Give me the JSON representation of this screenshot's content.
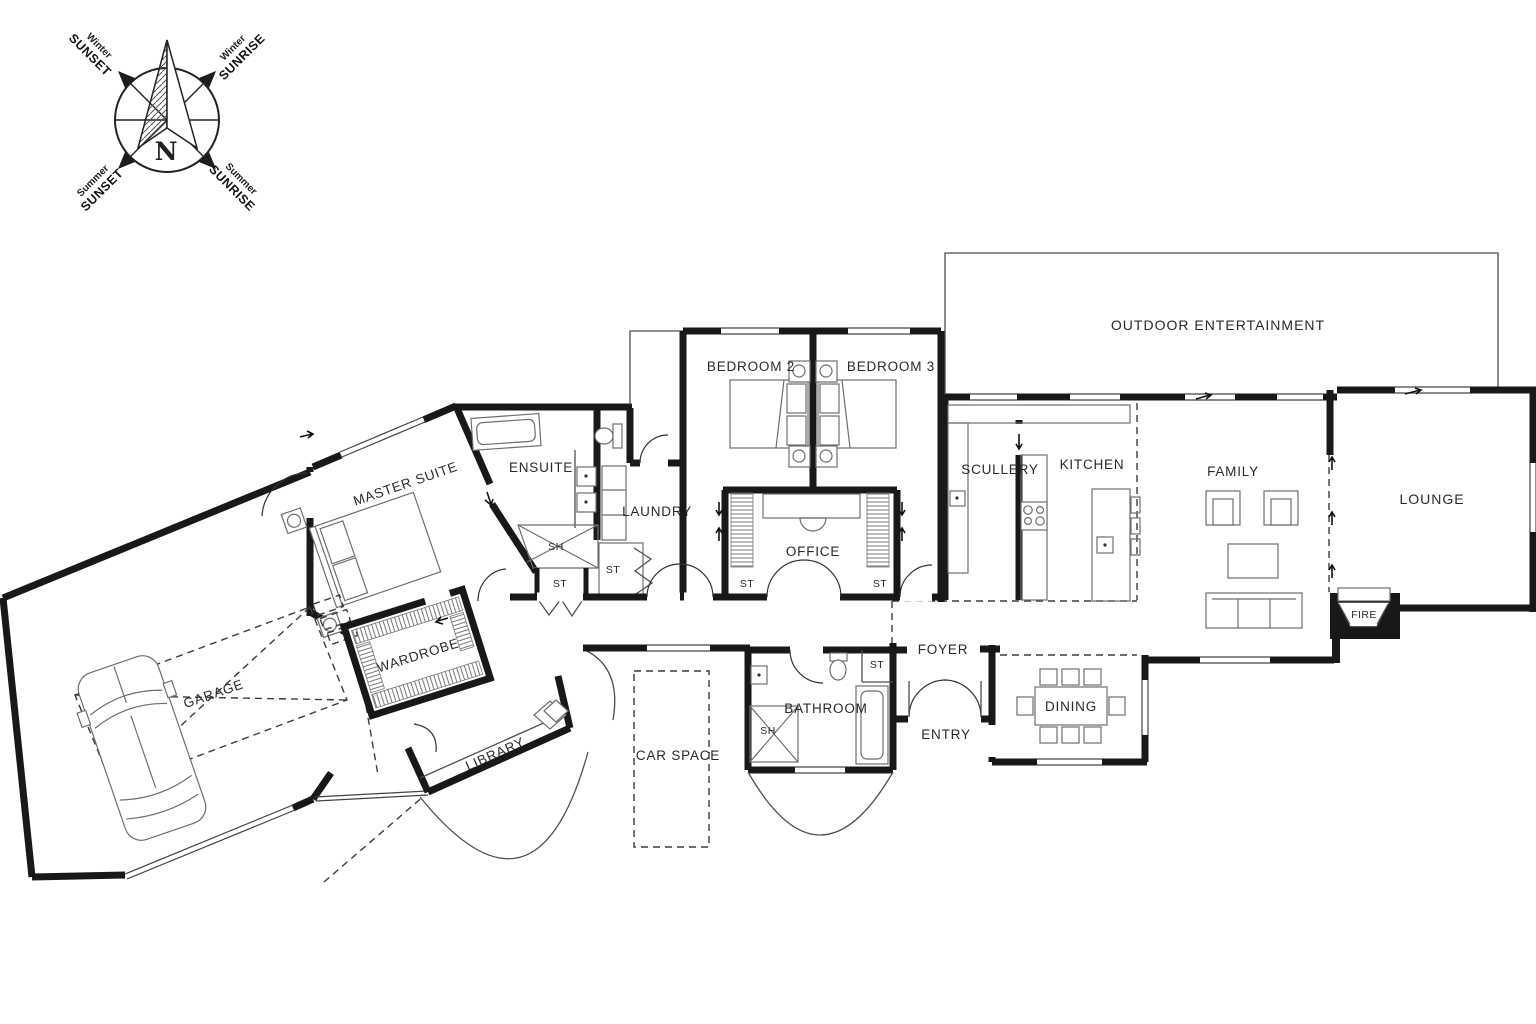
{
  "compass": {
    "north": "N",
    "directions": [
      {
        "season": "Winter",
        "event": "SUNSET"
      },
      {
        "season": "Winter",
        "event": "SUNRISE"
      },
      {
        "season": "Summer",
        "event": "SUNSET"
      },
      {
        "season": "Summer",
        "event": "SUNRISE"
      }
    ]
  },
  "rooms": {
    "garage": "GARAGE",
    "master_suite": "MASTER SUITE",
    "wardrobe": "WARDROBE",
    "library": "LIBRARY",
    "ensuite": "ENSUITE",
    "laundry": "LAUNDRY",
    "bedroom2": "BEDROOM 2",
    "bedroom3": "BEDROOM 3",
    "office": "OFFICE",
    "car_space": "CAR SPACE",
    "bathroom": "BATHROOM",
    "foyer": "FOYER",
    "entry": "ENTRY",
    "scullery": "SCULLERY",
    "kitchen": "KITCHEN",
    "family": "FAMILY",
    "dining": "DINING",
    "lounge": "LOUNGE",
    "outdoor": "OUTDOOR ENTERTAINMENT"
  },
  "fixtures": {
    "storage": "ST",
    "shower": "SH",
    "fire": "FIRE"
  },
  "colors": {
    "wall": "#181818",
    "thin_line": "#4f4f4f",
    "text": "#2a2a2a",
    "background": "#ffffff"
  }
}
